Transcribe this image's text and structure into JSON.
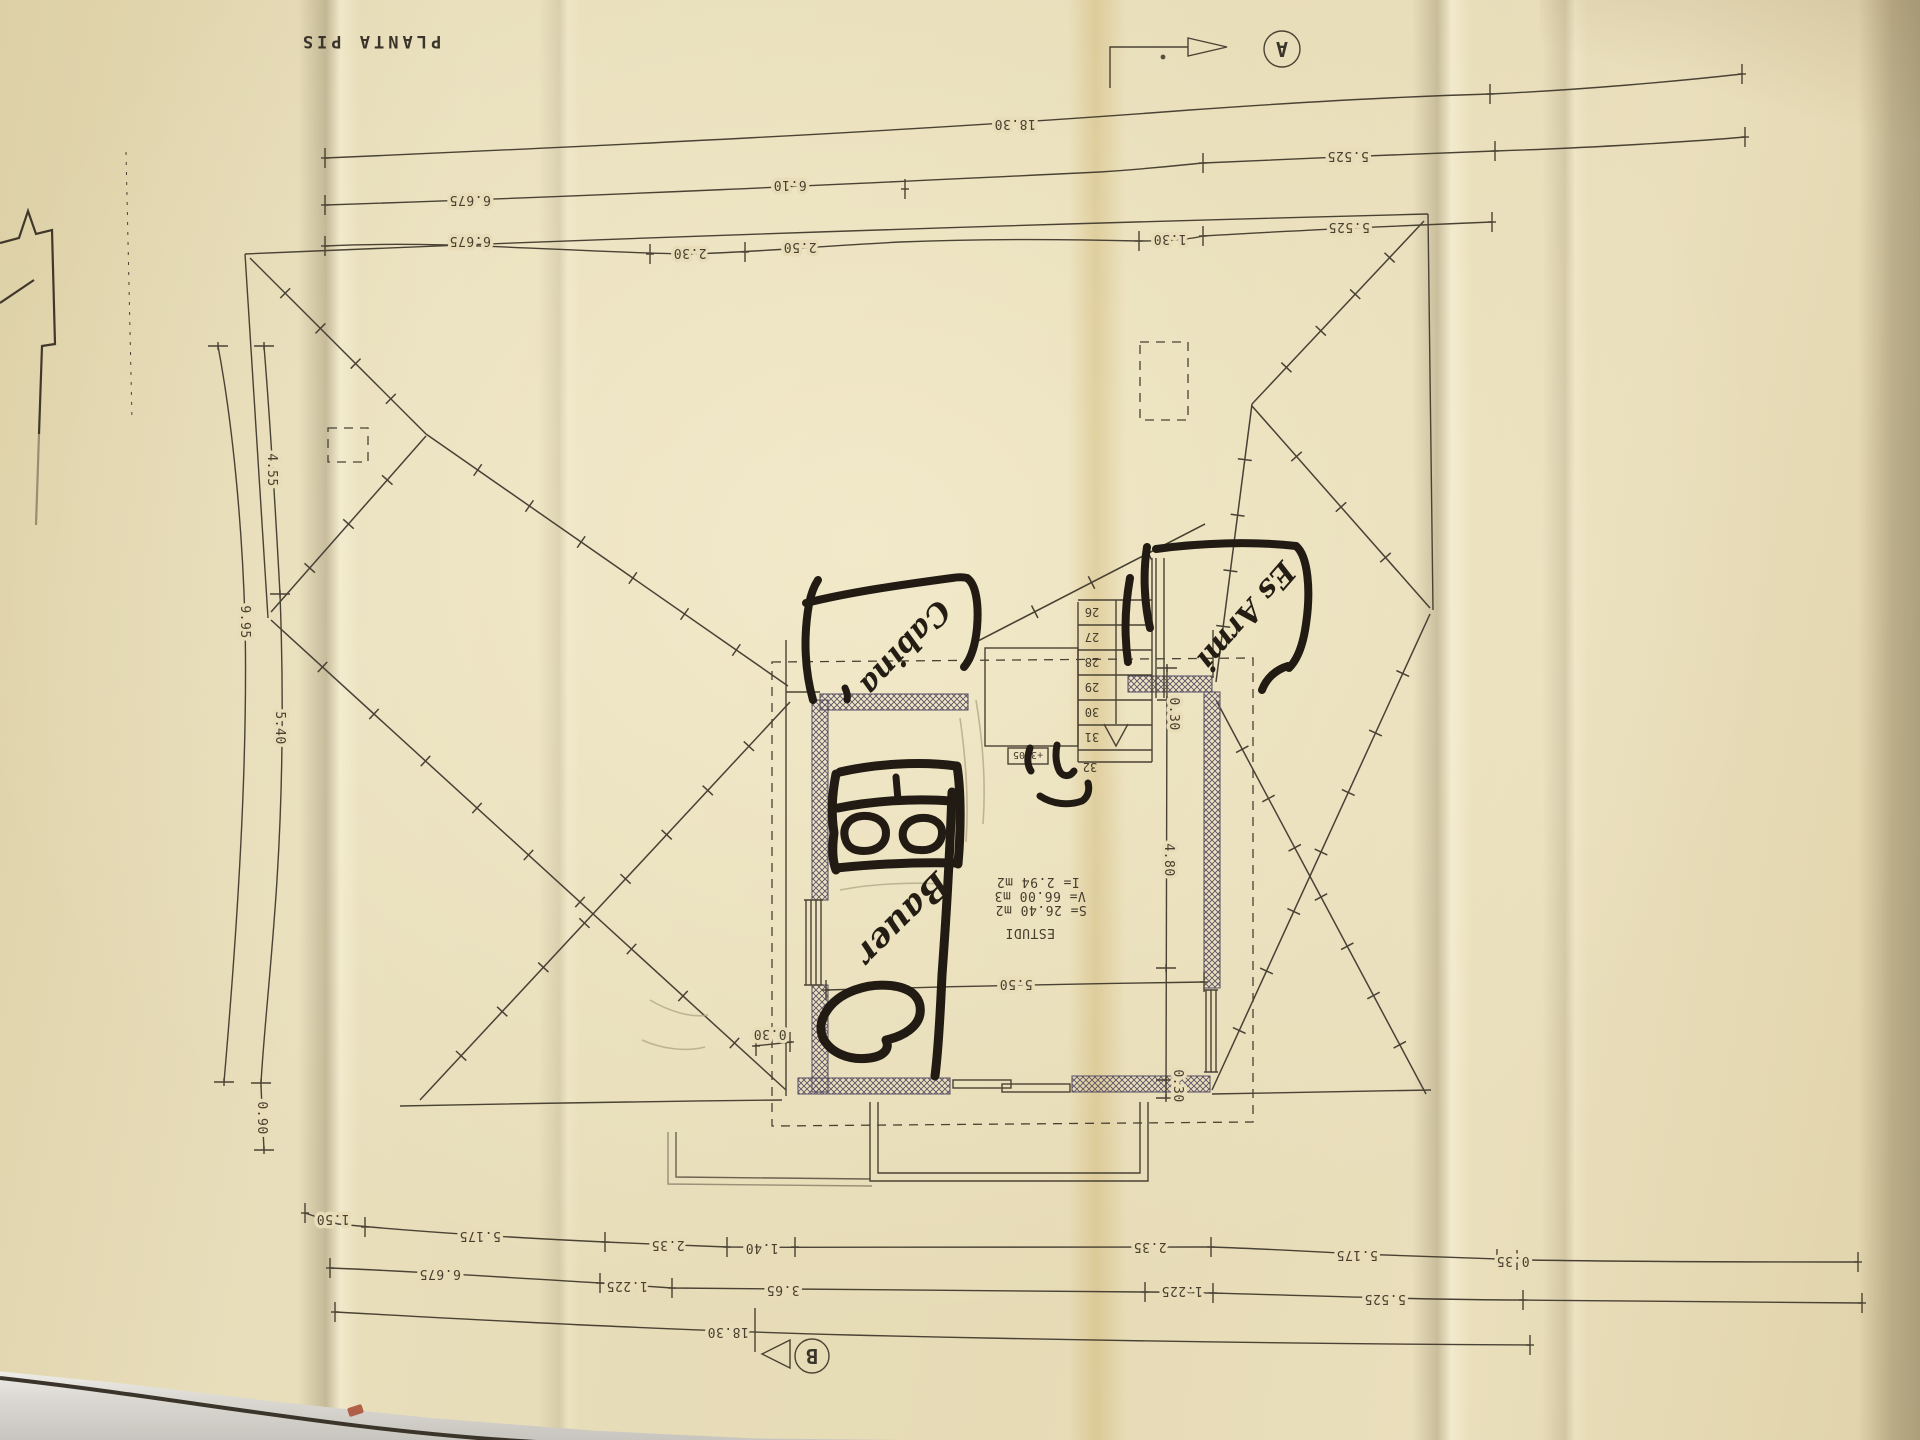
{
  "colors": {
    "paper": "#e7dcb7",
    "ink": "#49412f",
    "wall_hatch": "#5c5165",
    "marker": "#221c15",
    "table": "#d8d5cf"
  },
  "title": "PLANTA PIS",
  "markers": {
    "a": "A",
    "b": "B"
  },
  "room": {
    "name": "ESTUDI",
    "surface": "S= 26.40 m2",
    "volume": "V= 66.00 m3",
    "illum": "I= 2.94 m2",
    "level": "+3.05"
  },
  "stairs": [
    "26",
    "27",
    "28",
    "29",
    "30",
    "31",
    "32"
  ],
  "handwriting": {
    "cabina": "Cabina",
    "armari": "Es Armi",
    "bauer": "Bauer"
  },
  "dims": {
    "top1": [
      "18.30"
    ],
    "top2": [
      "6.675",
      "6.10",
      "5.525"
    ],
    "top3": [
      "6.675",
      "2.30",
      "2.50",
      "1.30",
      "5.525"
    ],
    "left": [
      "4.55",
      "9.95",
      "5.40",
      "0.90"
    ],
    "bottom1": [
      "1.50",
      "5.175",
      "2.35",
      "1.40",
      "2.35",
      "5.175",
      "0.35"
    ],
    "bottom2": [
      "6.675",
      "1.225",
      "3.65",
      "1.225",
      "5.525"
    ],
    "bottom3": [
      "18.30"
    ],
    "inner": {
      "w": "5.50",
      "d": "4.80",
      "t1": "0.30",
      "t2": "0.30",
      "t3": "0.30"
    }
  }
}
